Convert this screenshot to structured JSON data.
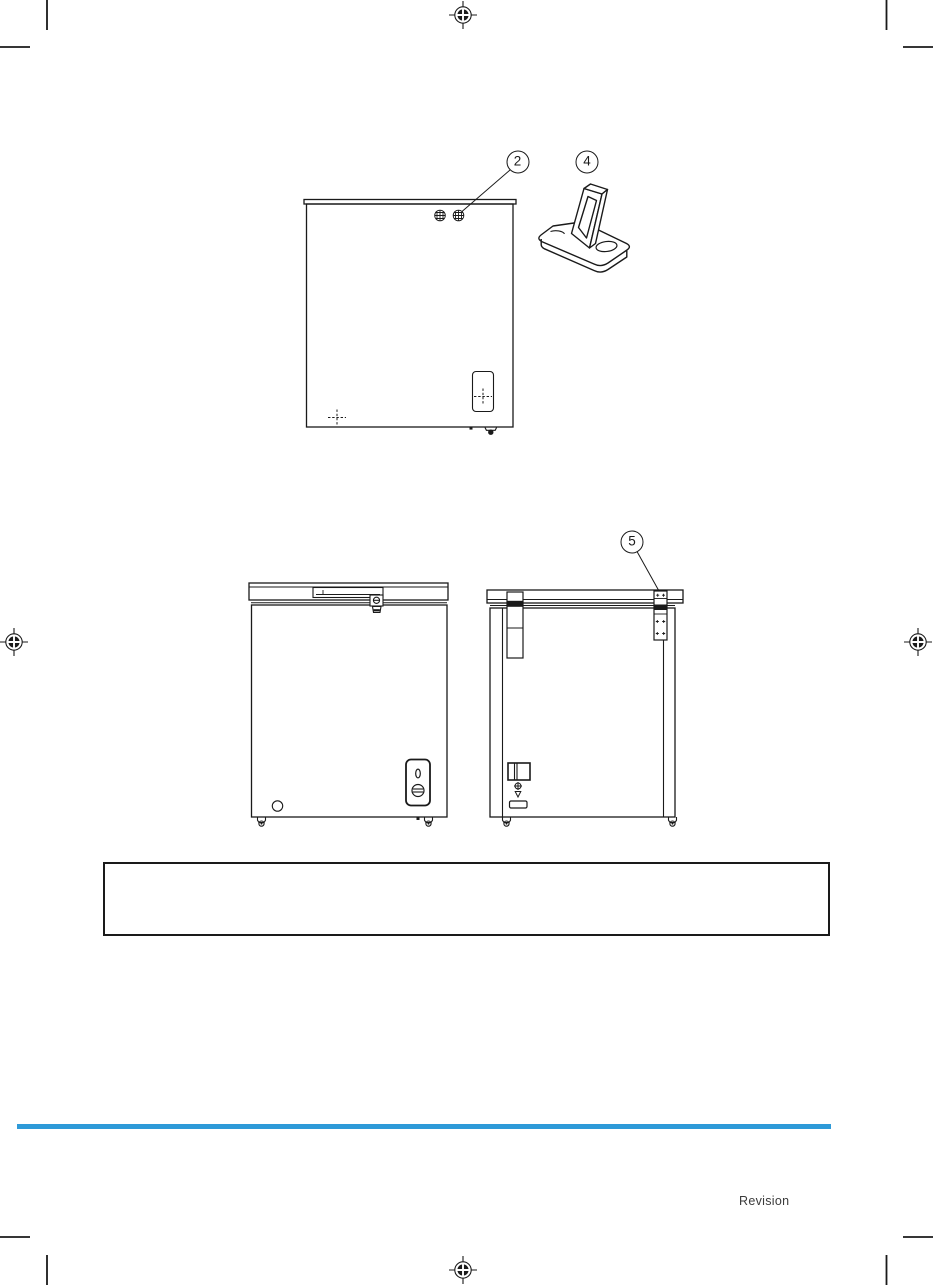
{
  "page": {
    "revision_label": "Revision"
  },
  "colors": {
    "ink": "#1a1a1a",
    "divider_blue": "#2E9AD8"
  },
  "callouts": [
    {
      "number": "2",
      "target": "lid-screws"
    },
    {
      "number": "4",
      "target": "hinge-cover-part"
    },
    {
      "number": "5",
      "target": "lid-hinge"
    }
  ]
}
